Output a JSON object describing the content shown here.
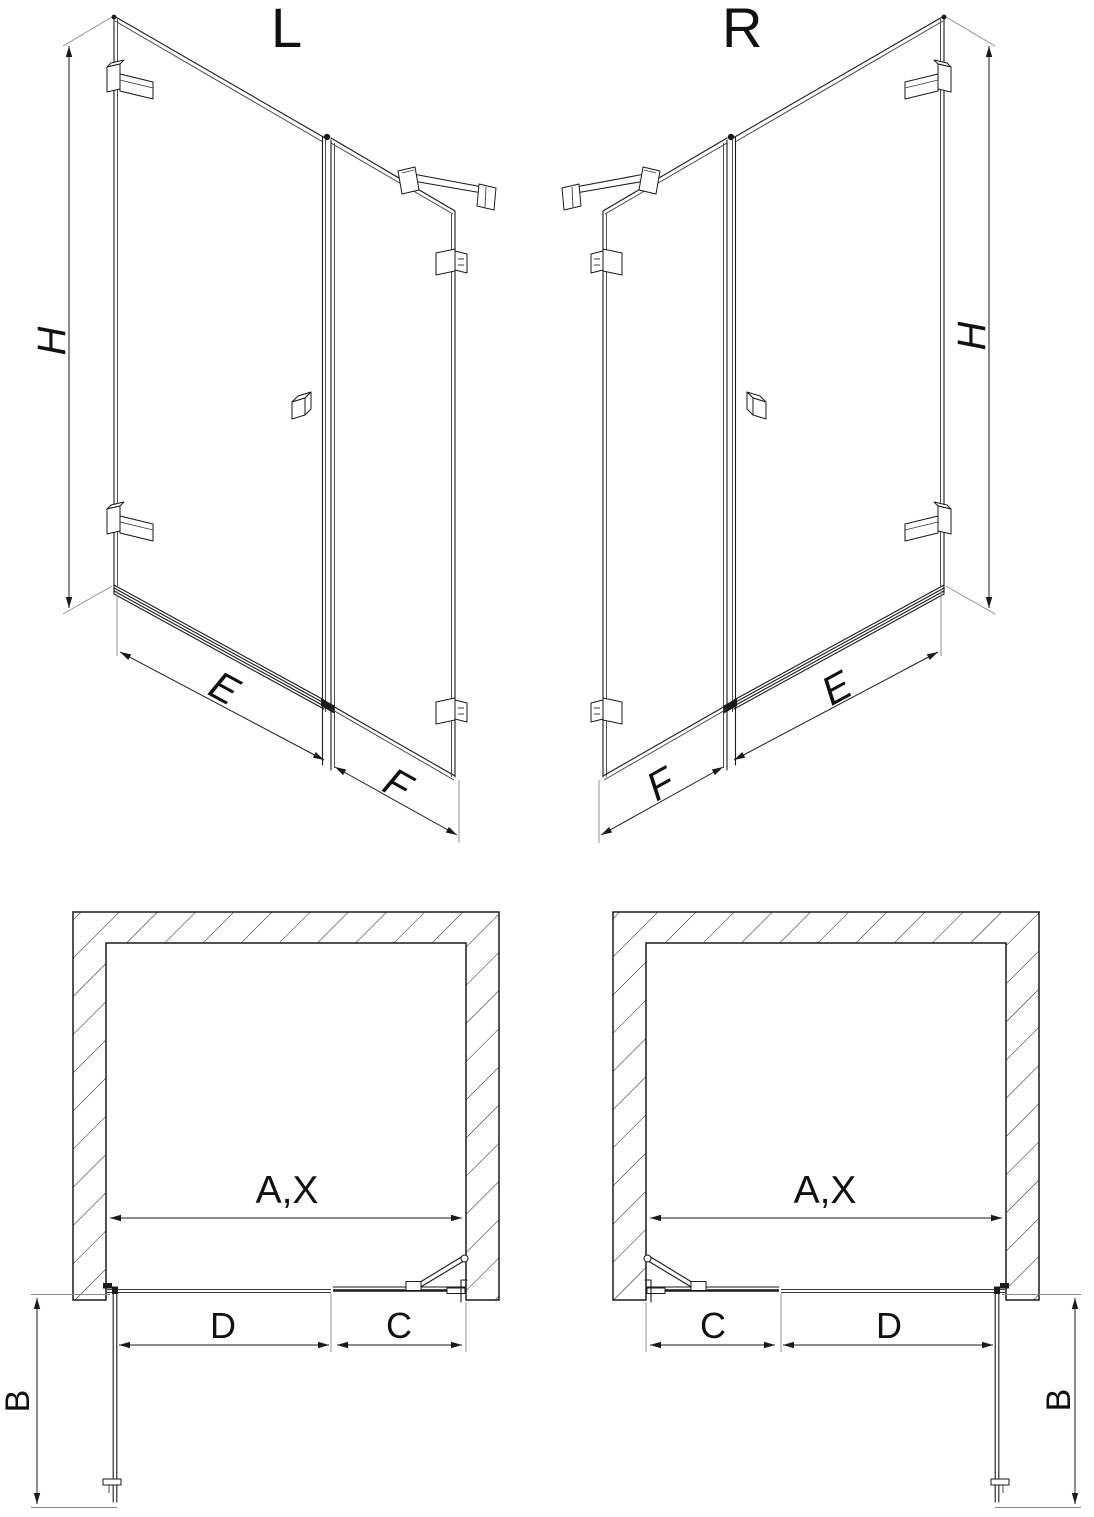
{
  "diagram": {
    "background": "#ffffff",
    "line_color": "#1a1a1a",
    "views": {
      "perspective_left": {
        "variant_label": "L",
        "dim_height": "H",
        "dim_door_width": "E",
        "dim_fixed_width": "F"
      },
      "perspective_right": {
        "variant_label": "R",
        "dim_height": "H",
        "dim_door_width": "E",
        "dim_fixed_width": "F"
      },
      "plan_left": {
        "dim_opening_width": "A,X",
        "dim_door_depth": "B",
        "dim_door_width": "D",
        "dim_fixed_width": "C"
      },
      "plan_right": {
        "dim_opening_width": "A,X",
        "dim_door_depth": "B",
        "dim_door_width": "D",
        "dim_fixed_width": "C"
      }
    }
  }
}
